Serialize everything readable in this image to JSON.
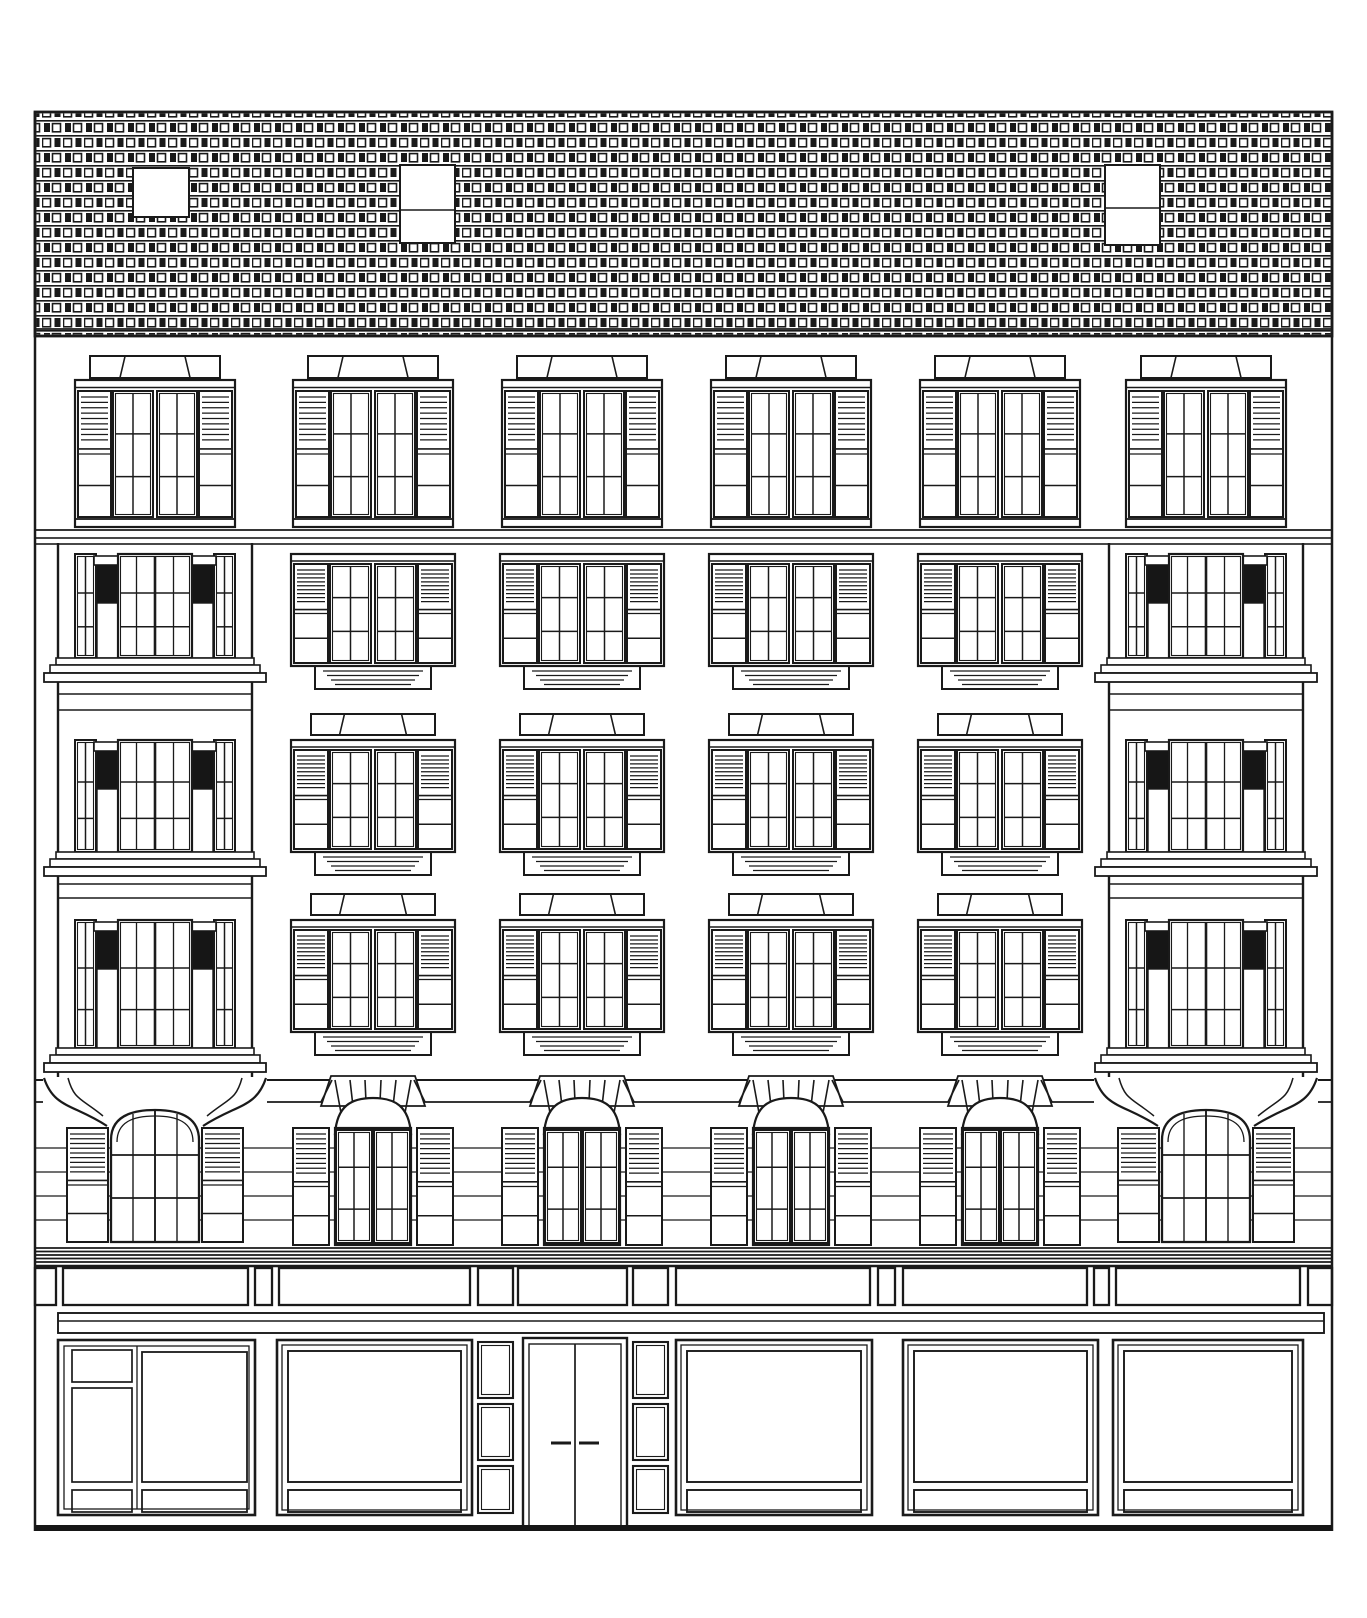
{
  "drawing": {
    "type": "architectural-elevation",
    "subject": "six-bay building facade line drawing with brick parapet, shuttered windows, corner bay towers, arched mezzanine windows and ground-floor storefronts"
  },
  "canvas": {
    "width": 1367,
    "height": 1618,
    "background": "#ffffff",
    "line_color": "#1a1a1a",
    "capital_color": "#161616"
  },
  "building": {
    "left": 35,
    "right": 1332,
    "top": 112
  },
  "roof_band": {
    "top": 112,
    "bottom": 336,
    "inner_line_y": 329,
    "texture": "brick-tile",
    "skylights": [
      {
        "x": 133,
        "y": 168,
        "w": 56,
        "h": 49,
        "panes": 1,
        "split_y": 0
      },
      {
        "x": 400,
        "y": 165,
        "w": 55,
        "h": 78,
        "panes": 2,
        "split_y": 210
      },
      {
        "x": 1105,
        "y": 165,
        "w": 55,
        "h": 80,
        "panes": 2,
        "split_y": 208
      }
    ]
  },
  "attic_row": {
    "centers": [
      155,
      373,
      582,
      791,
      1000,
      1206
    ],
    "pediment_y": 356,
    "window_top": 380,
    "window_height": 147,
    "sill_y": 519,
    "floor_line_y": 530,
    "band_y": 538,
    "band_h": 6
  },
  "middle_columns": [
    373,
    582,
    791,
    1000
  ],
  "middle_rows": [
    {
      "top": 554,
      "pediment": false
    },
    {
      "top": 740,
      "pediment": true
    },
    {
      "top": 920,
      "pediment": true
    }
  ],
  "bay_towers": [
    {
      "x": 58,
      "width": 194,
      "side": "left"
    },
    {
      "x": 1109,
      "width": 194,
      "side": "right"
    }
  ],
  "tower": {
    "stories": [
      {
        "t": 554,
        "h": 104
      },
      {
        "t": 740,
        "h": 112
      },
      {
        "t": 920,
        "h": 128
      }
    ],
    "spandrel_lines": [
      [
        694,
        710
      ],
      [
        884,
        898
      ]
    ],
    "top": 543,
    "bottom": 1079
  },
  "mezzanine": {
    "band_line_y": 1080,
    "shoulder_line_y": 1102,
    "rustication_lines": [
      1148,
      1172,
      1196,
      1220
    ],
    "window_top": 1128,
    "window_bottom": 1245,
    "sunburst_rays": 6
  },
  "main_cornice": {
    "lines": [
      1248,
      1251.5,
      1255,
      1258.5,
      1262,
      1266
    ]
  },
  "sign_band": {
    "top": 1268,
    "height": 37,
    "elements": [
      {
        "kind": "block",
        "x": 35,
        "w": 21
      },
      {
        "kind": "panel",
        "x": 63,
        "w": 185
      },
      {
        "kind": "block",
        "x": 255,
        "w": 17
      },
      {
        "kind": "panel",
        "x": 279,
        "w": 191
      },
      {
        "kind": "block",
        "x": 478,
        "w": 35
      },
      {
        "kind": "panel",
        "x": 518,
        "w": 109
      },
      {
        "kind": "block",
        "x": 633,
        "w": 35
      },
      {
        "kind": "panel",
        "x": 676,
        "w": 194
      },
      {
        "kind": "block",
        "x": 878,
        "w": 17
      },
      {
        "kind": "panel",
        "x": 903,
        "w": 184
      },
      {
        "kind": "block",
        "x": 1094,
        "w": 15
      },
      {
        "kind": "panel",
        "x": 1116,
        "w": 184
      },
      {
        "kind": "block",
        "x": 1308,
        "w": 24
      }
    ]
  },
  "belt_course": {
    "x": 58,
    "x2": 1324,
    "top": 1313,
    "mid_line": 1321,
    "bottom": 1333
  },
  "storefront": {
    "top": 1340,
    "bottom": 1515,
    "pane_top": 1351,
    "pane_bottom": 1482,
    "kick_top": 1490,
    "kick_bottom": 1512,
    "bays": [
      {
        "type": "composite-window",
        "x": 58,
        "w": 197
      },
      {
        "type": "display-window",
        "x": 277,
        "w": 195
      },
      {
        "type": "panel-stack",
        "x": 478,
        "w": 35
      },
      {
        "type": "double-door",
        "x": 523,
        "w": 104
      },
      {
        "type": "panel-stack",
        "x": 633,
        "w": 35
      },
      {
        "type": "display-window",
        "x": 676,
        "w": 196
      },
      {
        "type": "display-window",
        "x": 903,
        "w": 195
      },
      {
        "type": "display-window",
        "x": 1113,
        "w": 190
      }
    ]
  },
  "door": {
    "top": 1338,
    "bottom": 1527,
    "leaf_split_x": 575,
    "handle_y": 1443
  },
  "panel_stack_rows": [
    [
      1342,
      56
    ],
    [
      1404,
      56
    ],
    [
      1466,
      47
    ]
  ],
  "ground_line": {
    "y": 1525,
    "h": 6
  }
}
